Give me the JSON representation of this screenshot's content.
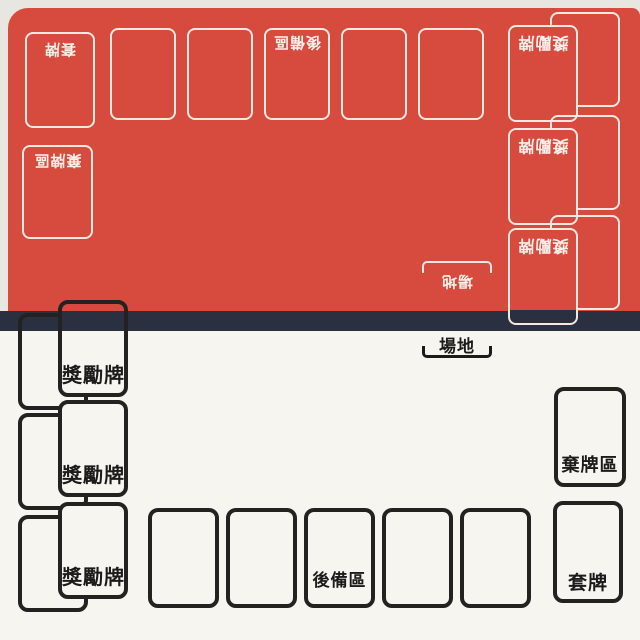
{
  "colors": {
    "opponent_red": "#d74a3e",
    "divider_navy": "#2a3040",
    "player_white": "#f7f5f0",
    "outline_on_red": "#f8eee8",
    "outline_on_white": "#232220"
  },
  "opponent_side": {
    "deck_label": "套牌",
    "discard_label": "棄牌區",
    "bench_label": "後備區",
    "prize_labels": [
      "獎勵牌",
      "獎勵牌",
      "獎勵牌"
    ],
    "stadium_label": "場地"
  },
  "player_side": {
    "deck_label": "套牌",
    "discard_label": "棄牌區",
    "bench_label": "後備區",
    "prize_labels": [
      "獎勵牌",
      "獎勵牌",
      "獎勵牌"
    ],
    "stadium_label": "場地"
  }
}
